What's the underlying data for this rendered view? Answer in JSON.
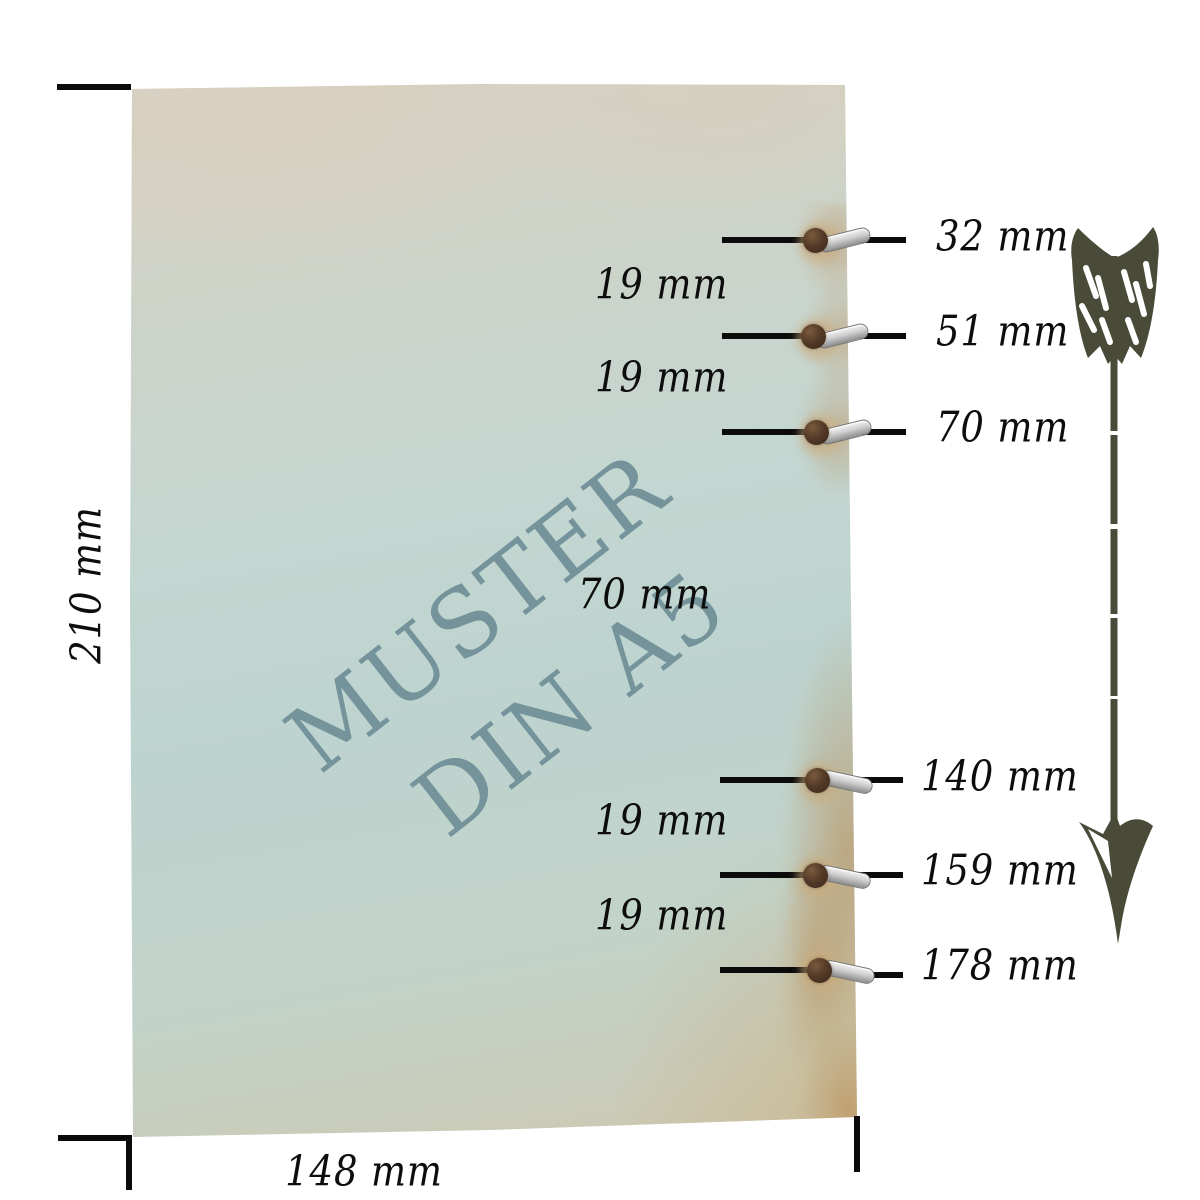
{
  "diagram": {
    "title": "MUSTER DIN A5",
    "watermark": {
      "line1": "MUSTER",
      "line2": "DIN A5"
    },
    "sheet": {
      "height_label": "210 mm",
      "width_label": "148 mm"
    },
    "hole_positions": [
      {
        "label": "32 mm"
      },
      {
        "label": "51 mm"
      },
      {
        "label": "70 mm"
      },
      {
        "label": "140 mm"
      },
      {
        "label": "159 mm"
      },
      {
        "label": "178 mm"
      }
    ],
    "hole_spacings": [
      {
        "label": "19 mm"
      },
      {
        "label": "19 mm"
      },
      {
        "label": "70 mm"
      },
      {
        "label": "19 mm"
      },
      {
        "label": "19 mm"
      }
    ],
    "icons": {
      "arrow": "feathered-down-arrow"
    },
    "colors": {
      "paper_beige": "#d8d1c2",
      "paper_teal": "#bdd3cf",
      "watermark_teal": "#6f8e97",
      "tan_wear": "#be9462",
      "line_black": "#0b0b0b",
      "arrow_olive": "#4a4a39",
      "ring_silver": "#cfcfcf",
      "hole_brown": "#553b28"
    }
  }
}
